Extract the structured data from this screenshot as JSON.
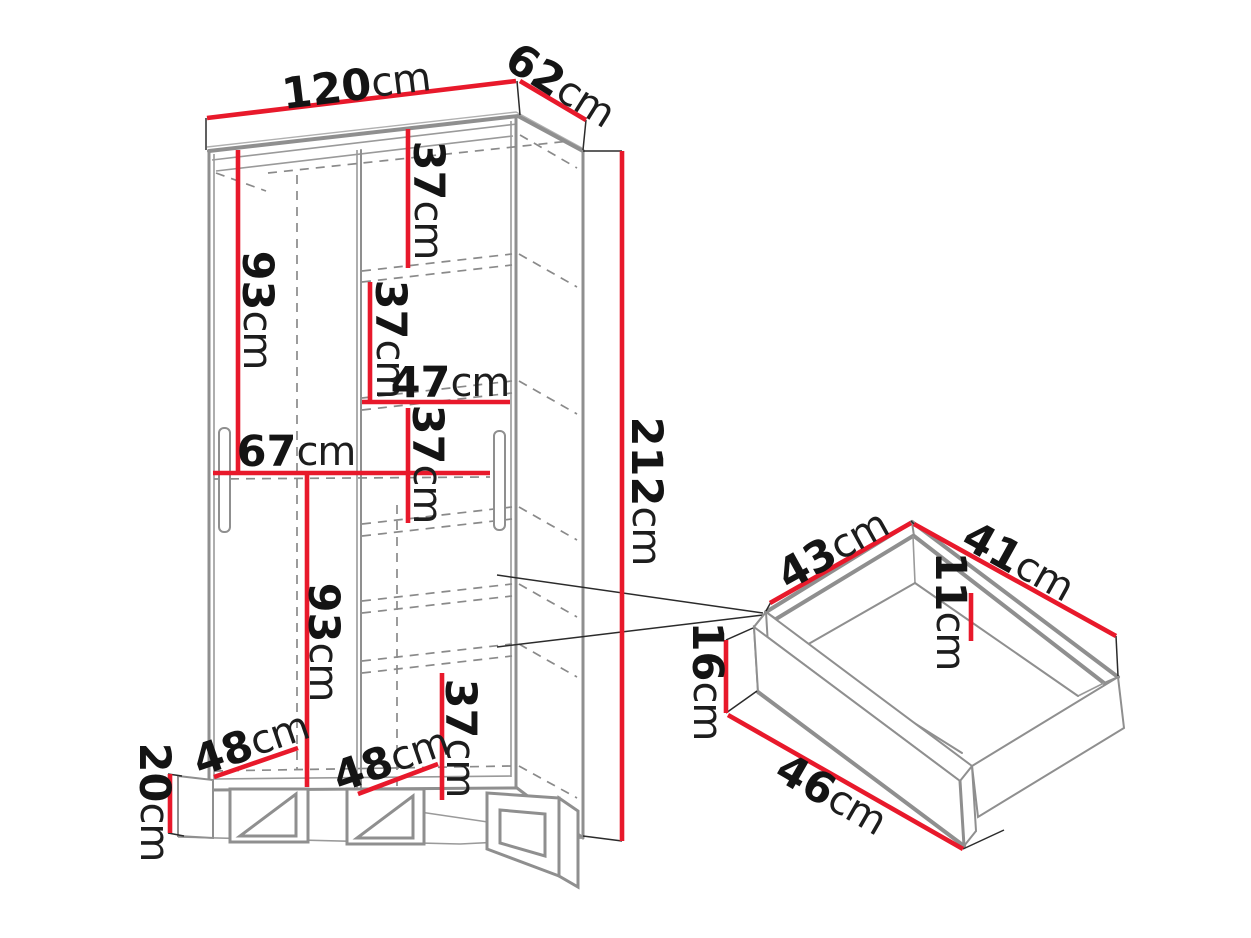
{
  "colors": {
    "dimension_line": "#e8192b",
    "structure_line": "#8f8f8f",
    "label_text": "#141414",
    "background": "#ffffff"
  },
  "wardrobe": {
    "name": "wardrobe-with-sliding-doors",
    "dims": {
      "width": {
        "num": "120",
        "unit": "cm"
      },
      "depth": {
        "num": "62",
        "unit": "cm"
      },
      "height": {
        "num": "212",
        "unit": "cm"
      },
      "top_shelf_gap": {
        "num": "37",
        "unit": "cm"
      },
      "second_shelf_gap": {
        "num": "37",
        "unit": "cm"
      },
      "shelf_width": {
        "num": "47",
        "unit": "cm"
      },
      "third_shelf_gap": {
        "num": "37",
        "unit": "cm"
      },
      "left_upper_height": {
        "num": "93",
        "unit": "cm"
      },
      "left_compartment_width": {
        "num": "67",
        "unit": "cm"
      },
      "left_lower_height": {
        "num": "93",
        "unit": "cm"
      },
      "bottom_shelf_gap": {
        "num": "37",
        "unit": "cm"
      },
      "left_foot_inset": {
        "num": "48",
        "unit": "cm"
      },
      "right_foot_inset": {
        "num": "48",
        "unit": "cm"
      },
      "plinth_height": {
        "num": "20",
        "unit": "cm"
      }
    }
  },
  "drawer": {
    "name": "pull-out-drawer-detail",
    "dims": {
      "side_depth": {
        "num": "43",
        "unit": "cm"
      },
      "back_width": {
        "num": "41",
        "unit": "cm"
      },
      "inner_height": {
        "num": "11",
        "unit": "cm"
      },
      "front_height": {
        "num": "16",
        "unit": "cm"
      },
      "front_width": {
        "num": "46",
        "unit": "cm"
      }
    }
  }
}
